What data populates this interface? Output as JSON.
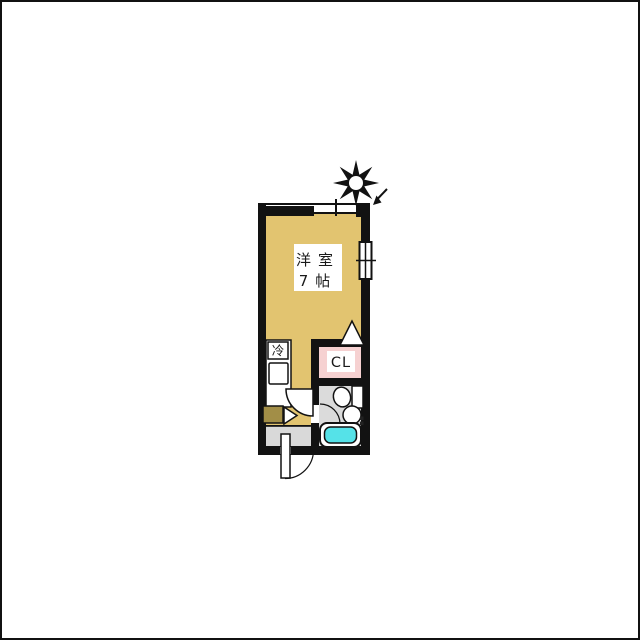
{
  "labels": {
    "room_name": "洋室",
    "room_size": "7帖",
    "closet": "CL",
    "fridge": "冷"
  },
  "colors": {
    "room_floor": "#E2C470",
    "closet_fill": "#F6D1D1",
    "bathtub_fill": "#55E2E8",
    "hard_floor": "#D9D9D9",
    "bath_floor": "#DBDBDB",
    "cabinet_fill": "#A28E47",
    "wall": "#121212",
    "canvas": "#FFFFFF"
  },
  "icons": {
    "compass": "sun-north-star-icon",
    "arrow": "direction-arrow-icon"
  }
}
